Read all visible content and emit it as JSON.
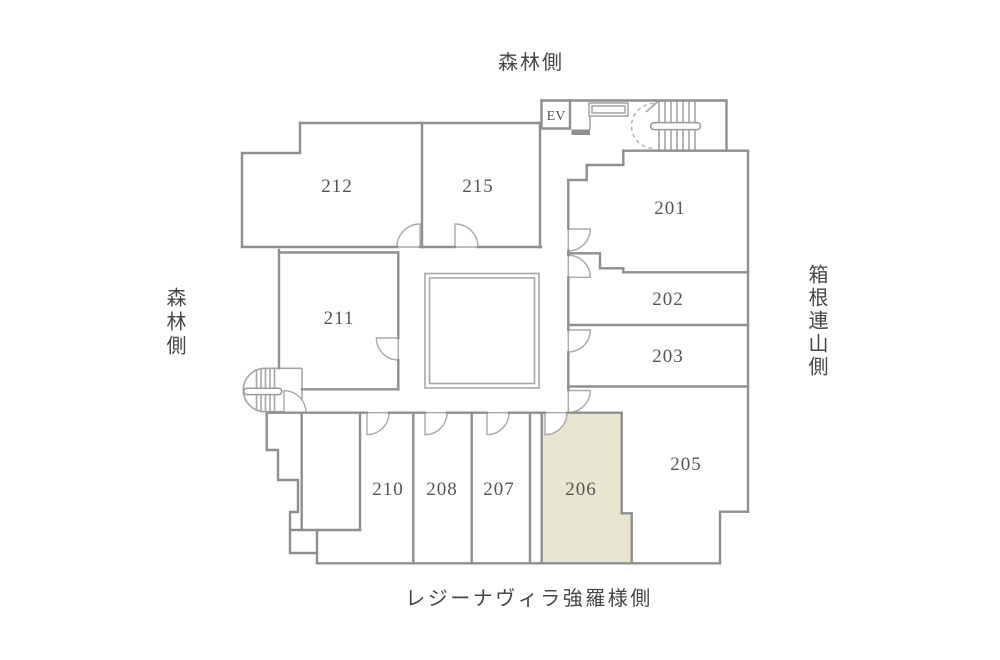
{
  "floorplan": {
    "orientation_labels": {
      "top": "森林側",
      "left": "森林側",
      "right": "箱根連山側",
      "bottom": "レジーナヴィラ強羅様側"
    },
    "elevator_label": "EV",
    "rooms": [
      {
        "number": "201",
        "highlighted": false
      },
      {
        "number": "202",
        "highlighted": false
      },
      {
        "number": "203",
        "highlighted": false
      },
      {
        "number": "205",
        "highlighted": false
      },
      {
        "number": "206",
        "highlighted": true
      },
      {
        "number": "207",
        "highlighted": false
      },
      {
        "number": "208",
        "highlighted": false
      },
      {
        "number": "210",
        "highlighted": false
      },
      {
        "number": "211",
        "highlighted": false
      },
      {
        "number": "212",
        "highlighted": false
      },
      {
        "number": "215",
        "highlighted": false
      }
    ],
    "colors": {
      "wall": "#8f8f8f",
      "detail": "#a6a6a6",
      "label_text": "#474747",
      "room_number_text": "#565656",
      "highlight_fill": "#e8e5d0",
      "background": "#ffffff"
    }
  }
}
